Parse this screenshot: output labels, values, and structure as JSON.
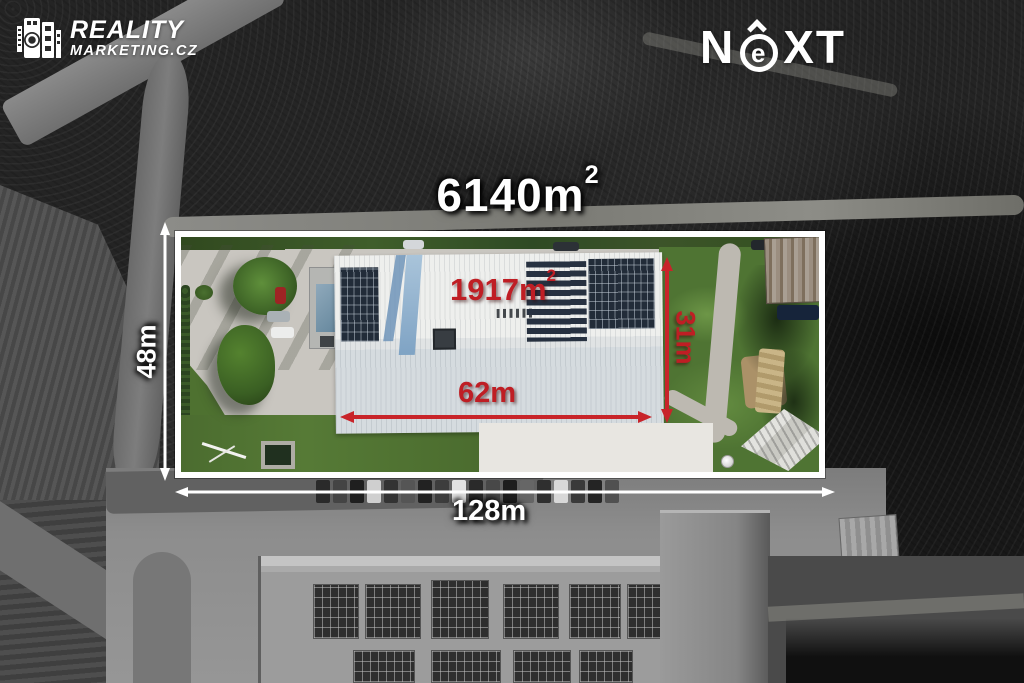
{
  "branding": {
    "reality_logo": {
      "title": "REALITY",
      "subtitle": "MARKETING.CZ"
    },
    "next_logo": {
      "left": "N",
      "e": "e",
      "right": "XT"
    }
  },
  "measurements": {
    "total_area": {
      "value": "6140m",
      "sup": "2"
    },
    "building_area": {
      "value": "1917m",
      "sup": "2"
    },
    "plot_depth": "48m",
    "plot_frontage": "128m",
    "building_length": "62m",
    "building_width": "31m"
  },
  "colors": {
    "accent_red": "#bf1e24",
    "overlay_white": "#ffffff"
  }
}
